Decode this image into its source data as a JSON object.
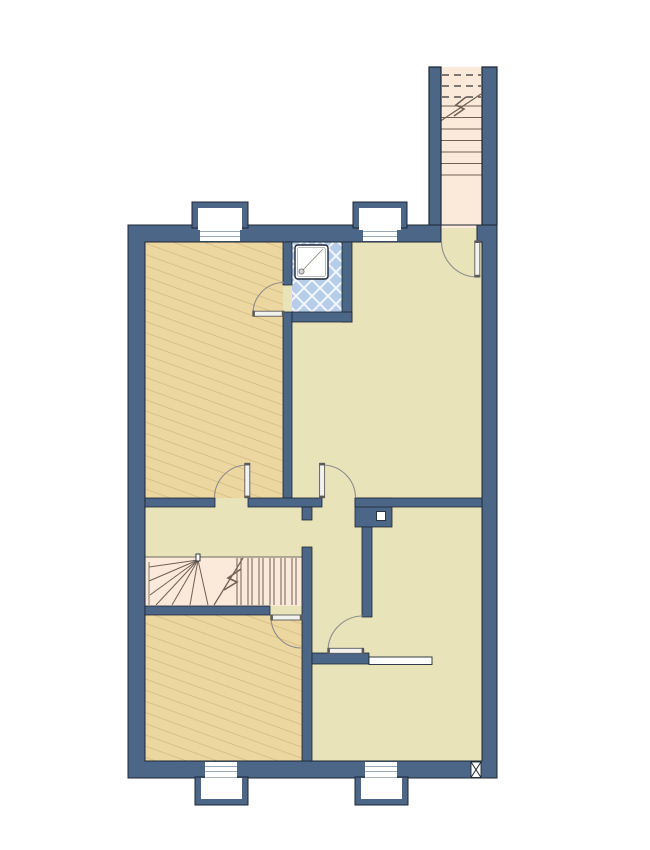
{
  "title": "floor-plan",
  "colors": {
    "bg": "#ffffff",
    "wall": "#4b6686",
    "line": "#1d2735",
    "room": "#e9e3ba",
    "hatch_bg": "#ecd7a0",
    "hatch_line": "#cdb37c",
    "stair": "#fbe9da",
    "stair_line": "#6f6154",
    "dash": "#55534f",
    "tile": "#b6cde9",
    "tile_line": "#f3f7fc",
    "glass_line": "#9aa6b0",
    "door": "#8c8c8c",
    "door_edge": "#5a5a5a",
    "leaf": "#f2f2ef",
    "white": "#ffffff"
  },
  "legend": {
    "rooms": [
      {
        "id": "room-top-left",
        "fill": "hatched"
      },
      {
        "id": "shower-room",
        "fill": "tiled",
        "fixtures": [
          "shower-tray",
          "drain"
        ]
      },
      {
        "id": "room-top-right",
        "fill": "plain"
      },
      {
        "id": "stair-hall",
        "fill": "plain",
        "fixtures": [
          "winder-staircase"
        ]
      },
      {
        "id": "corridor",
        "fill": "plain"
      },
      {
        "id": "room-bottom-left",
        "fill": "hatched"
      },
      {
        "id": "room-bottom-right",
        "fill": "plain"
      }
    ],
    "stairs": [
      {
        "id": "external-staircase-tower",
        "symbols": [
          "cut-line-dashes",
          "direction-line-with-break"
        ]
      },
      {
        "id": "internal-winder-staircase",
        "symbols": [
          "break-line"
        ]
      }
    ],
    "symbols": [
      {
        "id": "flue-square",
        "count": 1
      },
      {
        "id": "wall-vent-x",
        "count": 1
      },
      {
        "id": "pass-through-opening",
        "count": 1
      }
    ],
    "doors": 6,
    "window_bays": 4
  }
}
